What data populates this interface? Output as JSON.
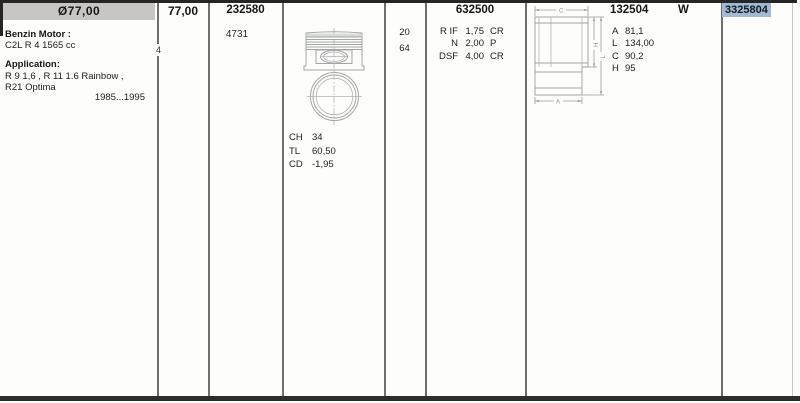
{
  "colors": {
    "header_bg": "#c7c6c3",
    "highlight_bg": "#a2b9d1",
    "highlight_text": "#101b28",
    "grid_line": "#6f6f6f",
    "frame_border": "#262626",
    "drawing_line": "#a4a6a5",
    "text": "#1d1d1d"
  },
  "row": {
    "bore_header": "Ø77,00",
    "bore_value": "77,00",
    "cylinder_count": "4",
    "engine": {
      "motor_label": "Benzin Motor :",
      "motor_value": "C2L R 4 1565 cc",
      "application_label": "Application:",
      "application_line1": "R 9 1,6 , R 11 1.6 Rainbow ,",
      "application_line2": "R21 Optima",
      "years": "1985...1995"
    },
    "piston": {
      "number": "232580",
      "code": "4731",
      "specs": [
        {
          "label": "CH",
          "value": "34"
        },
        {
          "label": "TL",
          "value": "60,50"
        },
        {
          "label": "CD",
          "value": "-1,95"
        }
      ]
    },
    "pin": {
      "values": [
        "20",
        "64"
      ]
    },
    "rings": {
      "number": "632500",
      "specs": [
        {
          "label": "R IF",
          "value": "1,75",
          "suffix": "CR"
        },
        {
          "label": "N",
          "value": "2,00",
          "suffix": "P"
        },
        {
          "label": "DSF",
          "value": "4,00",
          "suffix": "CR"
        }
      ]
    },
    "liner": {
      "number": "132504",
      "flag": "W",
      "specs": [
        {
          "label": "A",
          "value": "81,1"
        },
        {
          "label": "L",
          "value": "134,00"
        },
        {
          "label": "C",
          "value": "90,2"
        },
        {
          "label": "H",
          "value": "95"
        }
      ],
      "dims": {
        "top": "C",
        "inner": "H",
        "outer": "L",
        "bottom": "A"
      }
    },
    "reference": {
      "number": "3325804"
    }
  }
}
